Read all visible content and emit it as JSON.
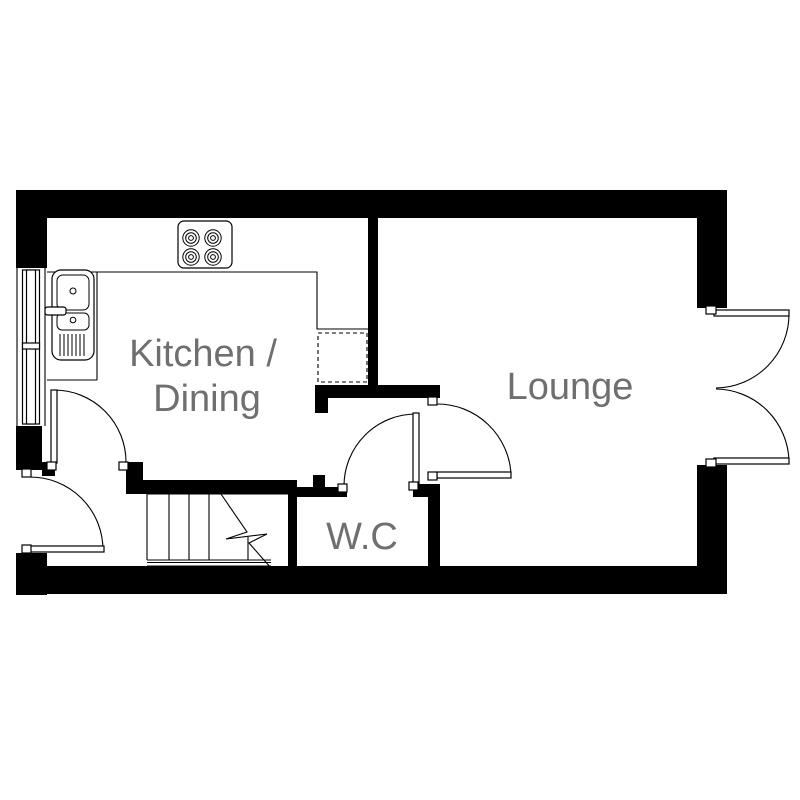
{
  "plan": {
    "rooms": [
      {
        "id": "kitchen-dining",
        "label_line1": "Kitchen /",
        "label_line2": "Dining"
      },
      {
        "id": "lounge",
        "label": "Lounge"
      },
      {
        "id": "wc",
        "label": "W.C"
      }
    ],
    "fixtures": [
      {
        "icon": "hob-icon",
        "room": "kitchen-dining",
        "burners": 4
      },
      {
        "icon": "sink-icon",
        "room": "kitchen-dining"
      },
      {
        "icon": "appliance-space-icon",
        "room": "kitchen-dining"
      },
      {
        "icon": "stairs-icon",
        "room": "hallway"
      },
      {
        "icon": "window-icon",
        "wall": "left"
      },
      {
        "icon": "double-doors-icon",
        "wall": "right"
      }
    ],
    "door_count": 6,
    "colors": {
      "wall": "#000000",
      "line": "#000000",
      "label": "#6f6f6f",
      "background": "#ffffff"
    }
  }
}
